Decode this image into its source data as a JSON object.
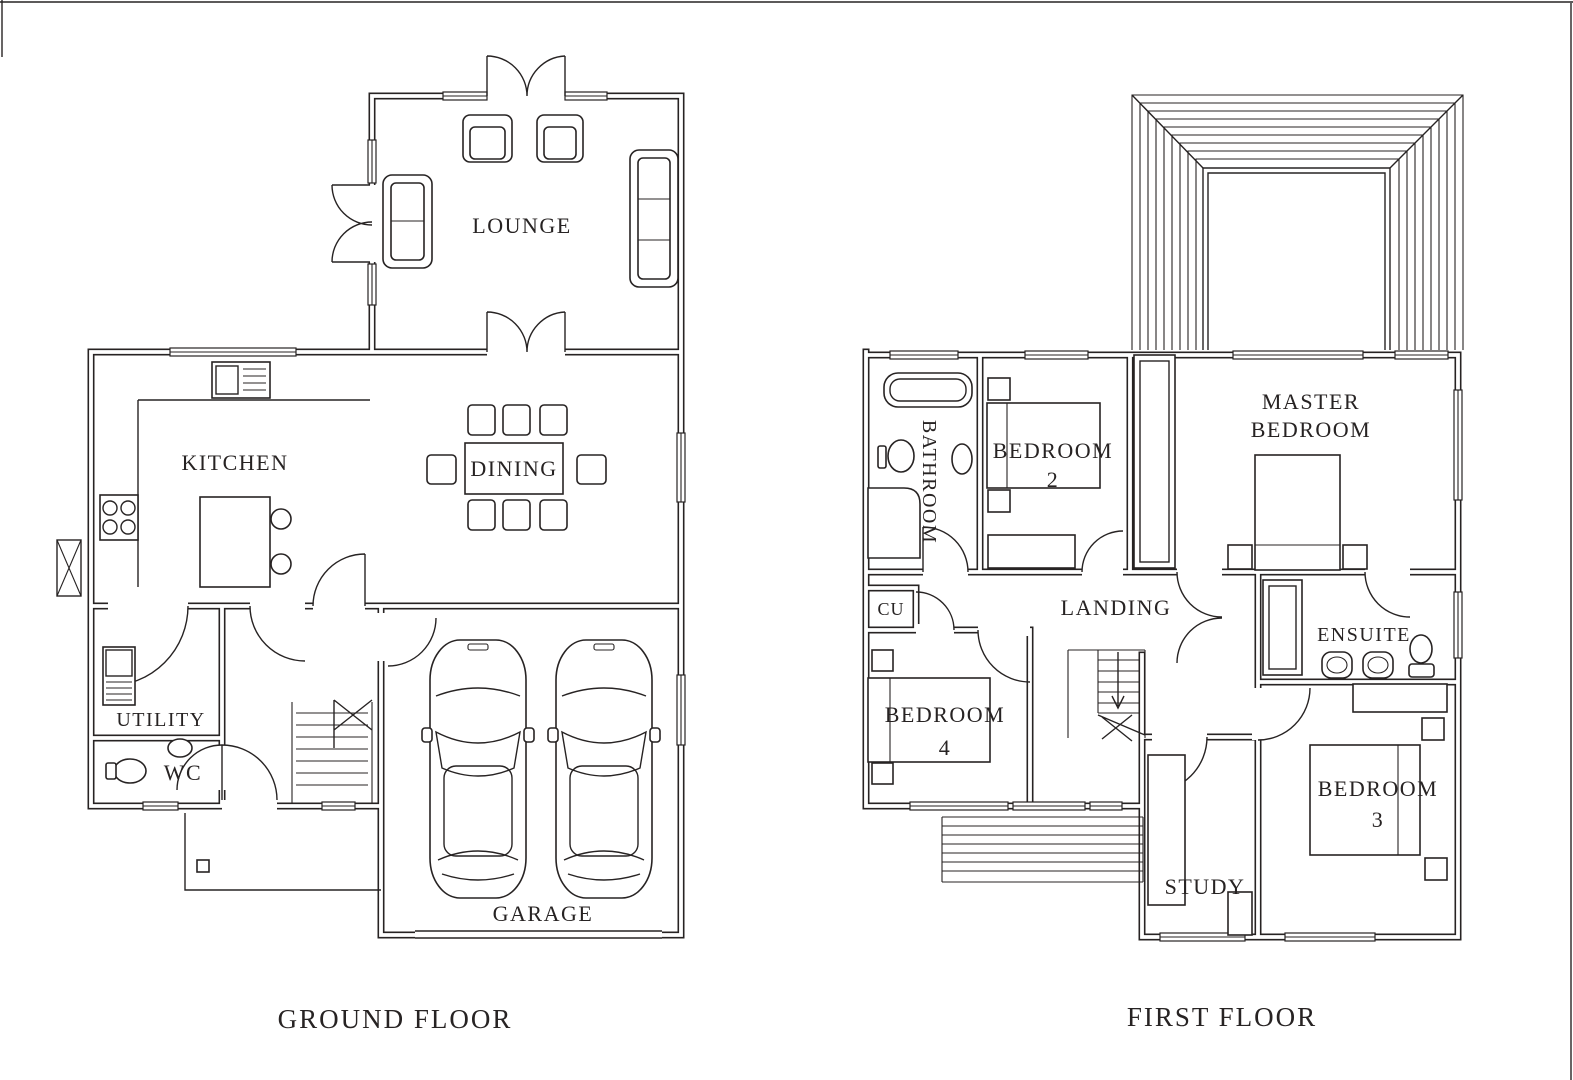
{
  "page": {
    "background": "#ffffff",
    "ink_color": "#272323"
  },
  "ground_floor": {
    "title": "GROUND FLOOR",
    "rooms": {
      "lounge": "LOUNGE",
      "kitchen": "KITCHEN",
      "dining": "DINING",
      "utility": "UTILITY",
      "wc": "WC",
      "garage": "GARAGE"
    }
  },
  "first_floor": {
    "title": "FIRST FLOOR",
    "rooms": {
      "bathroom": "BATHROOM",
      "bedroom2": {
        "line1": "BEDROOM",
        "line2": "2"
      },
      "master": {
        "line1": "MASTER",
        "line2": "BEDROOM"
      },
      "cu": "CU",
      "landing": "LANDING",
      "ensuite": "ENSUITE",
      "bedroom4": {
        "line1": "BEDROOM",
        "line2": "4"
      },
      "bedroom3": {
        "line1": "BEDROOM",
        "line2": "3"
      },
      "study": "STUDY"
    }
  }
}
